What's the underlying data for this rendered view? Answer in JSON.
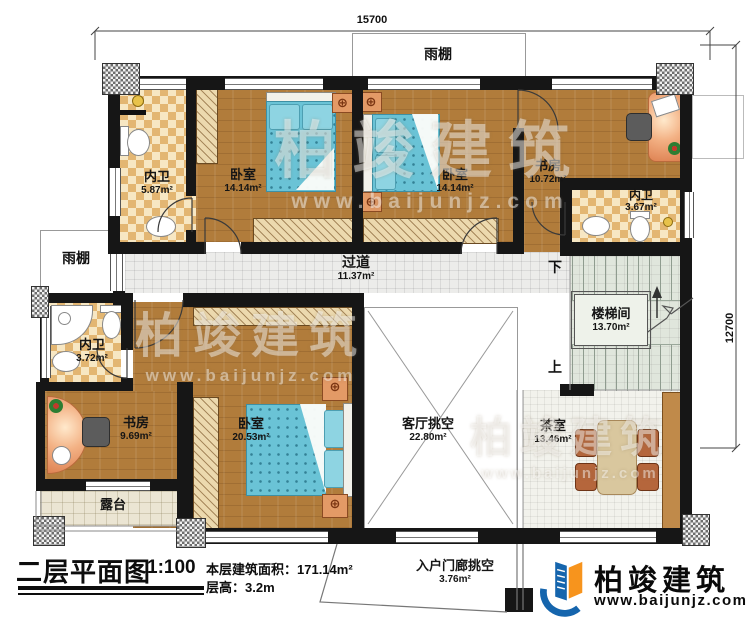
{
  "dimensions": {
    "top": "15700",
    "right": "12700"
  },
  "canopy": {
    "top": "雨棚",
    "left": "雨棚"
  },
  "stairs": {
    "name": "楼梯间",
    "area": "13.70m²",
    "down": "下",
    "up": "上"
  },
  "rooms": [
    {
      "name": "内卫",
      "area": "5.87m²"
    },
    {
      "name": "卧室",
      "area": "14.14m²"
    },
    {
      "name": "卧室",
      "area": "14.14m²"
    },
    {
      "name": "书房",
      "area": "10.72m²"
    },
    {
      "name": "内卫",
      "area": "3.67m²"
    },
    {
      "name": "过道",
      "area": "11.37m²"
    },
    {
      "name": "内卫",
      "area": "3.72m²"
    },
    {
      "name": "书房",
      "area": "9.69m²"
    },
    {
      "name": "卧室",
      "area": "20.53m²"
    },
    {
      "name": "客厅挑空",
      "area": "22.80m²"
    },
    {
      "name": "茶室",
      "area": "13.46m²"
    },
    {
      "name": "露台",
      "area": ""
    },
    {
      "name": "入户门廊挑空",
      "area": "3.76m²"
    }
  ],
  "title_block": {
    "title": "二层平面图",
    "scale": "1:100",
    "area": "本层建筑面积：171.14m²",
    "height": "层高：3.2m"
  },
  "brand": {
    "name": "柏竣建筑",
    "site": "www.baijunjz.com"
  },
  "watermark": {
    "name": "柏竣建筑",
    "site": "www.baijunjz.com"
  }
}
